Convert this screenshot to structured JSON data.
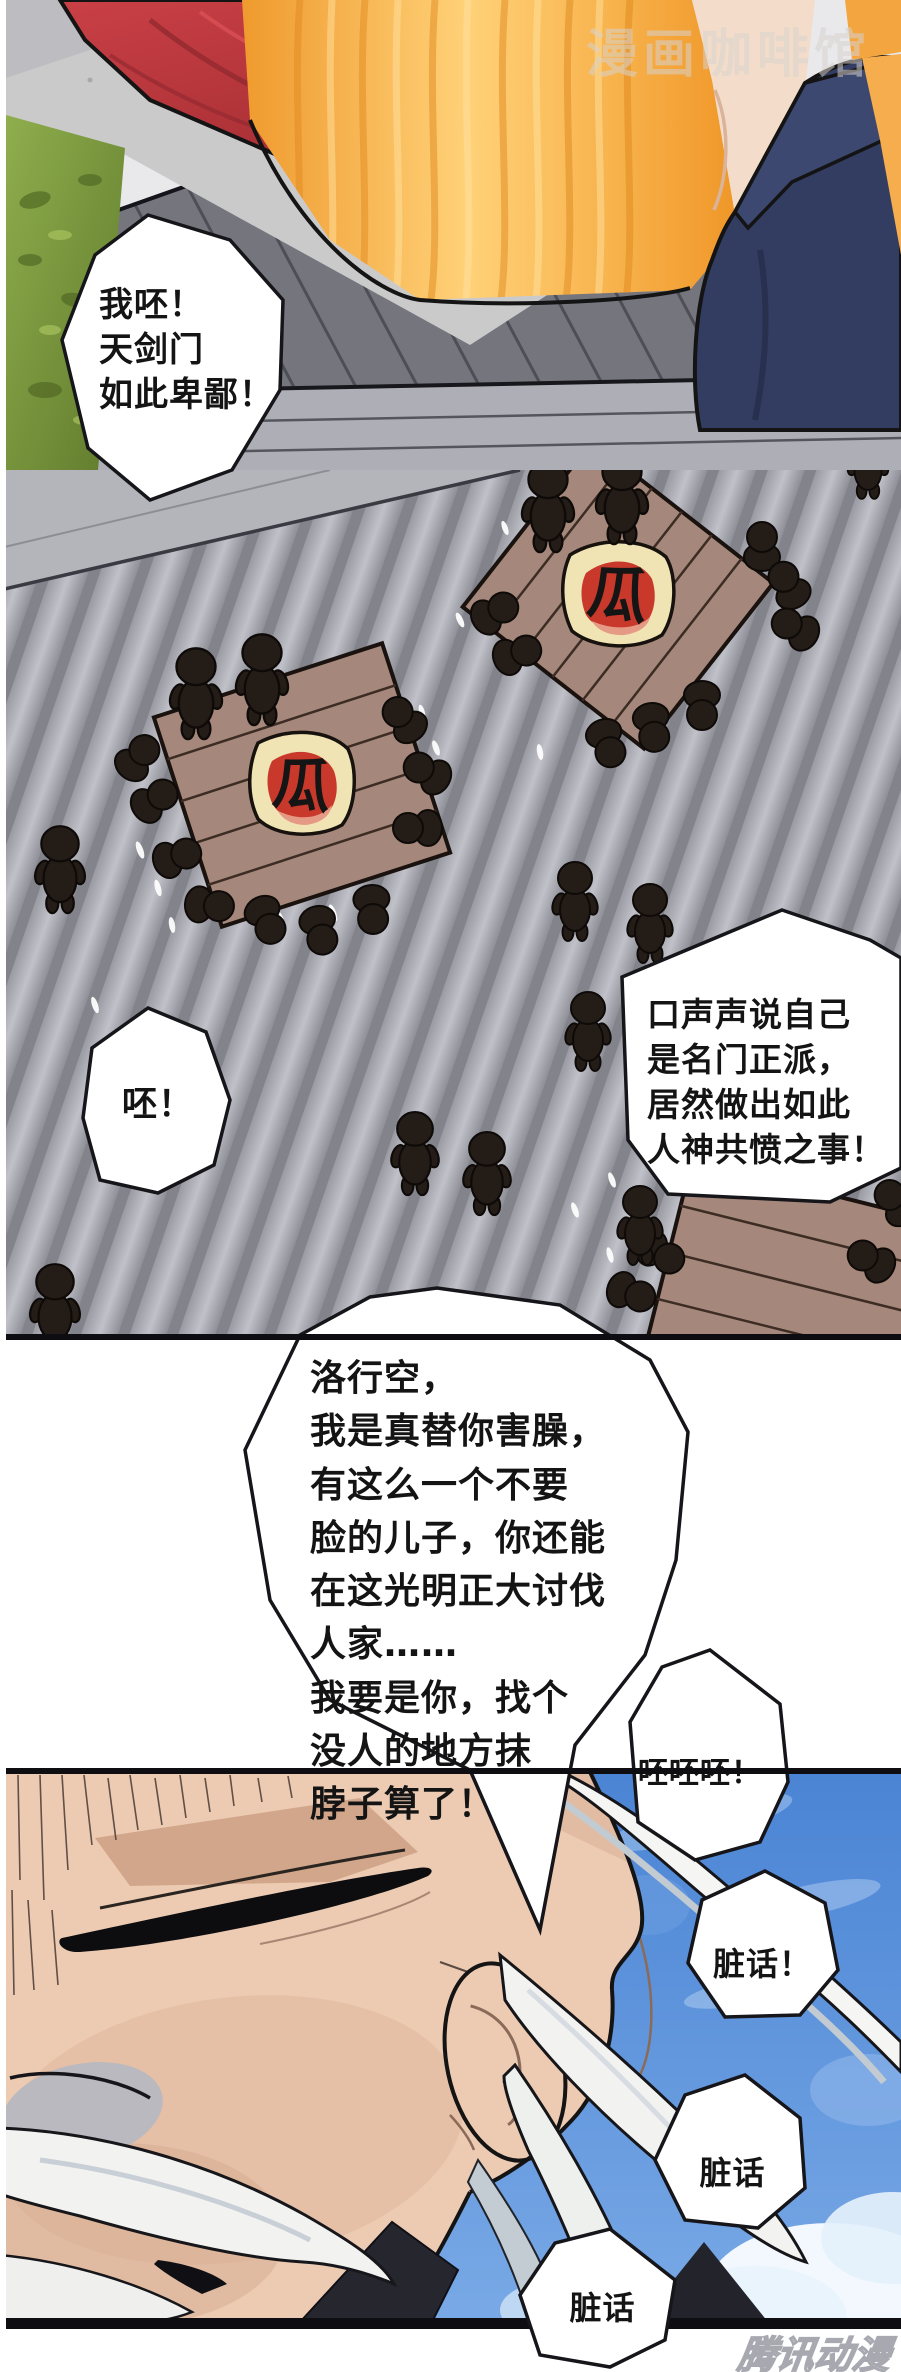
{
  "page": {
    "width": 901,
    "height": 2372,
    "type": "manhua-comic-page"
  },
  "watermarks": {
    "top_right": "漫画咖啡馆",
    "bottom_right": "腾讯动漫"
  },
  "emblem_char": "瓜",
  "bubbles": {
    "shout": "我呸！\n天剑门\n如此卑鄙！",
    "pei": "呸！",
    "accuse": "口声声说自己\n是名门正派，\n居然做出如此\n人神共愤之事！",
    "monologue": "洛行空，\n我是真替你害臊，\n有这么一个不要\n脸的儿子，你还能\n在这光明正大讨伐\n人家……\n我要是你，找个\n没人的地方抹\n脖子算了！",
    "pei3": "呸呸呸！",
    "dirty1": "脏话！",
    "dirty2": "脏话",
    "dirty3": "脏话"
  },
  "colors": {
    "sky_blue": "#4f88d6",
    "robe_orange": "#f5a83c",
    "garment_red": "#c63c41",
    "boot_navy": "#333d61",
    "table_wood": "#a5887b",
    "emblem_cream": "#f1e4b4",
    "emblem_red": "#c8392b",
    "skin": "#eccbb2",
    "silhouette_dark": "#241c17",
    "roof_gray": "#b6b6be",
    "grass_green": "#7f9c44"
  }
}
